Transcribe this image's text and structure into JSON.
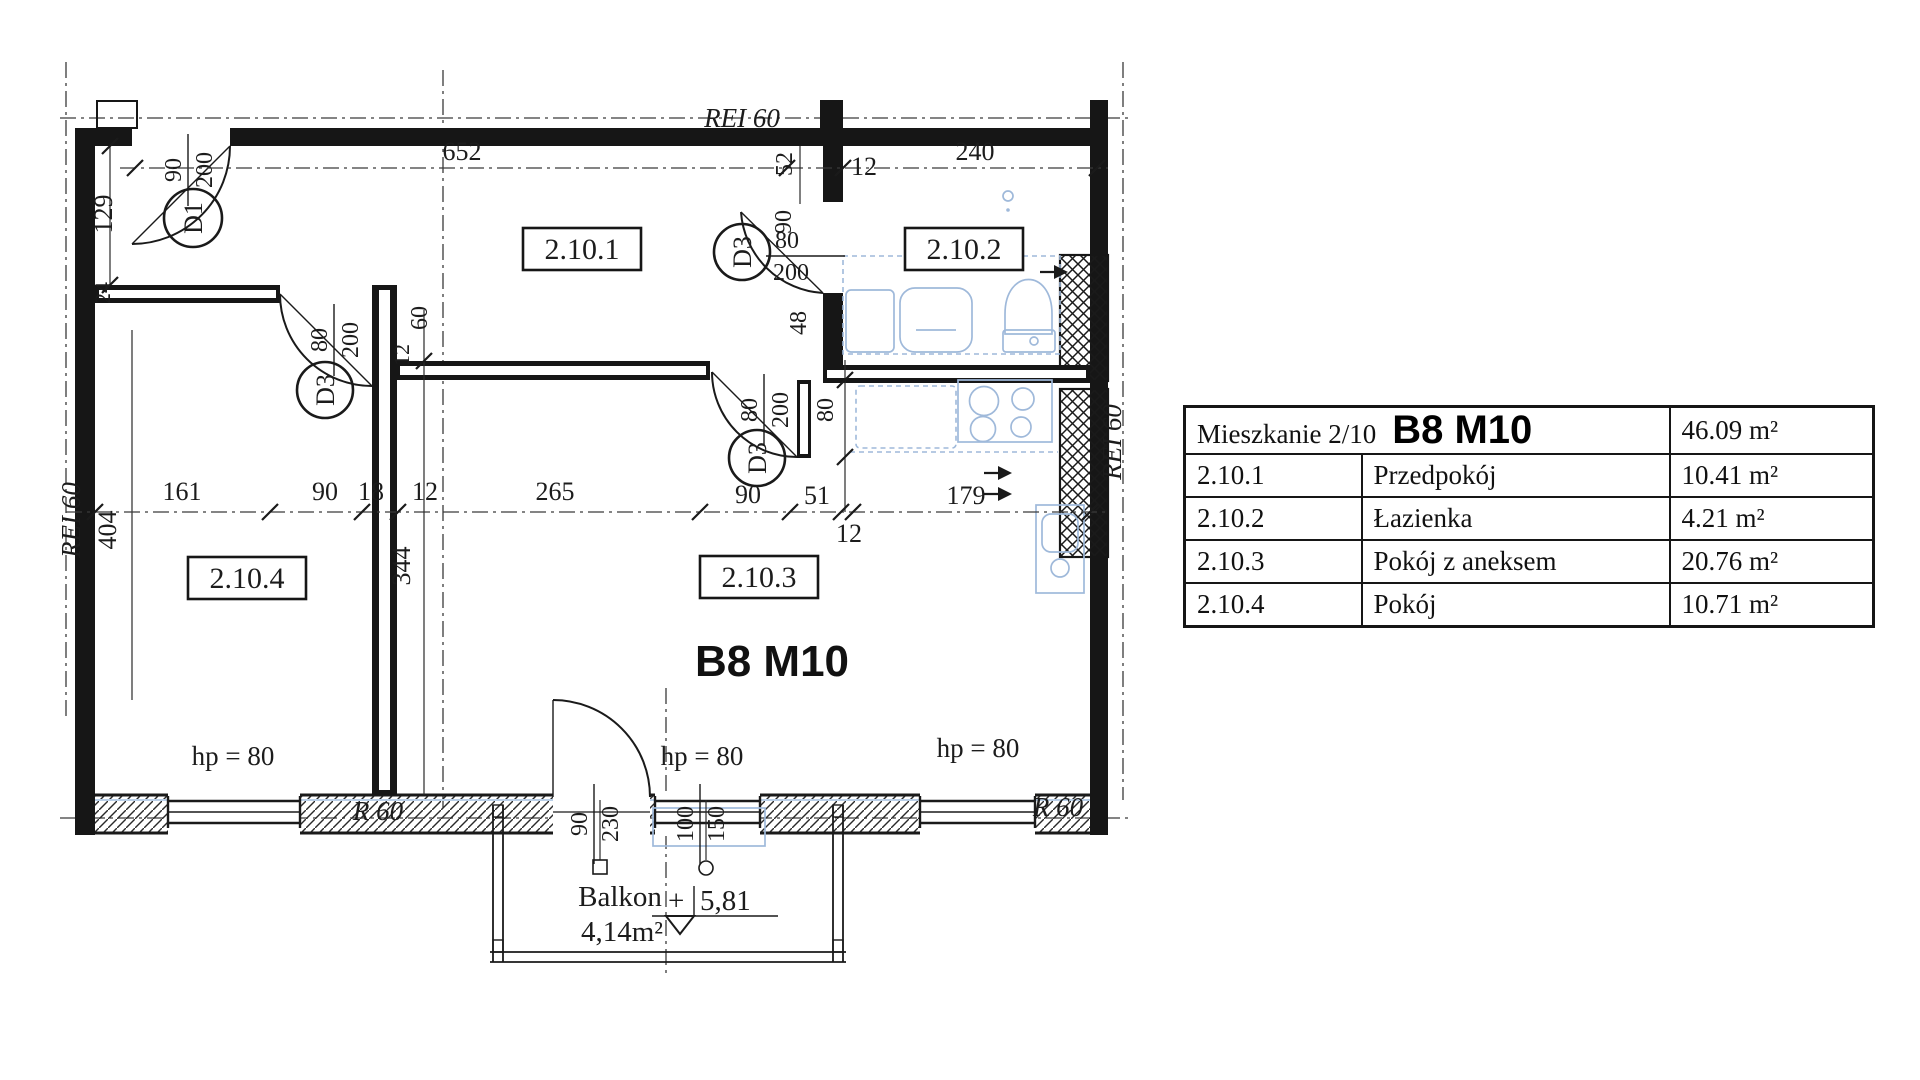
{
  "plan": {
    "code": "B8 M10",
    "rei60": "REI 60",
    "r60": "R 60",
    "hp80": "hp = 80",
    "rooms": {
      "r1": "2.10.1",
      "r2": "2.10.2",
      "r3": "2.10.3",
      "r4": "2.10.4"
    },
    "doors": {
      "d1": "D1",
      "d3": "D3"
    },
    "balcony": {
      "name": "Balkon",
      "area": "4,14m²",
      "plus": "+",
      "level": "5,81"
    },
    "dims": {
      "top652": "652",
      "top52": "52",
      "top12": "12",
      "top240": "240",
      "left129": "129",
      "left24": "24",
      "left404": "404",
      "row161": "161",
      "row90a": "90",
      "row18": "18",
      "row12a": "12",
      "row265": "265",
      "row90b": "90",
      "row51": "51",
      "row12b": "12",
      "row179": "179",
      "wall344": "344",
      "wall60": "60",
      "wall12": "12",
      "bath90": "90",
      "bath48": "48",
      "bath80": "80",
      "bath200": "200",
      "kit80": "80",
      "d80": "80",
      "d200": "200",
      "ent90": "90",
      "ent200": "200",
      "bd90": "90",
      "bd230": "230",
      "bw100": "100",
      "bw150": "150"
    }
  },
  "table": {
    "title": "Mieszkanie 2/10",
    "code": "B8 M10",
    "total": "46.09 m²",
    "rows": [
      {
        "id": "2.10.1",
        "name": "Przedpokój",
        "area": "10.41 m²"
      },
      {
        "id": "2.10.2",
        "name": "Łazienka",
        "area": "4.21 m²"
      },
      {
        "id": "2.10.3",
        "name": "Pokój z aneksem",
        "area": "20.76 m²"
      },
      {
        "id": "2.10.4",
        "name": "Pokój",
        "area": "10.71 m²"
      }
    ]
  }
}
